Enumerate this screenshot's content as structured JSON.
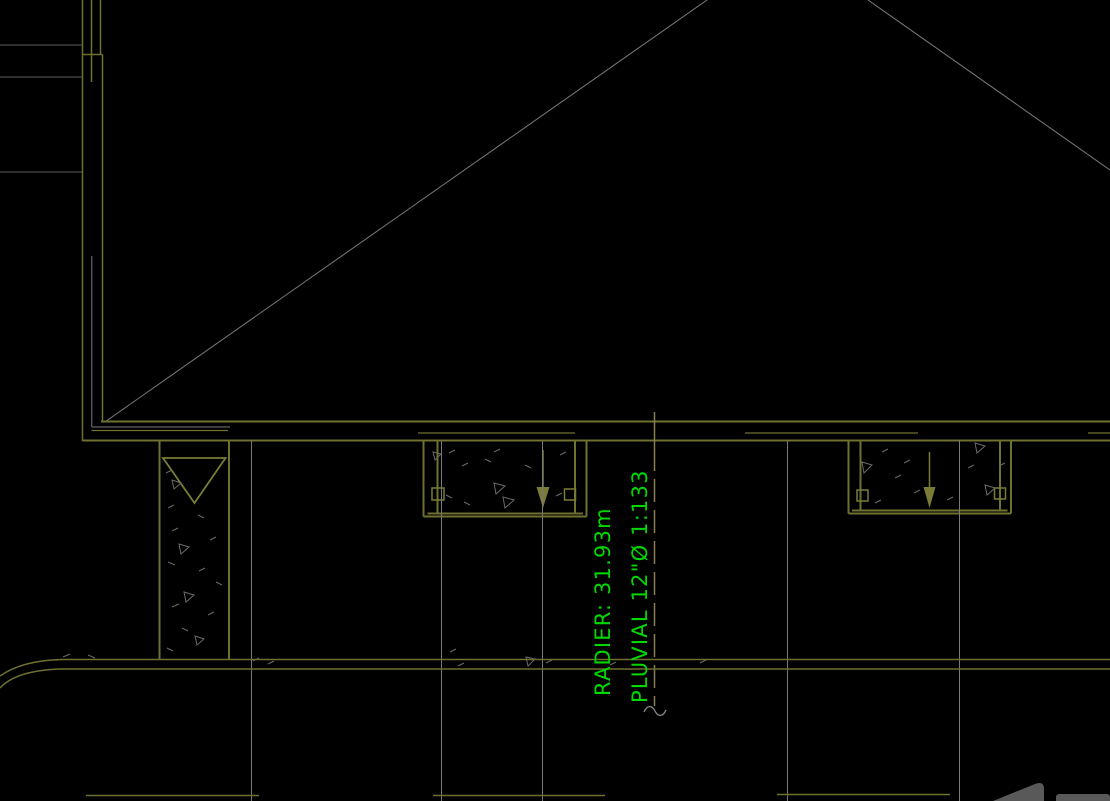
{
  "viewport": {
    "kind": "cad-drawing-viewport",
    "background": "#000000"
  },
  "annotation": {
    "rotation_deg": -90,
    "color": "#00d900",
    "lines": [
      {
        "id": "radier",
        "text": "RADIER: 31.93m"
      },
      {
        "id": "pluvial",
        "text": "PLUVIAL 12\"Ø 1:133"
      }
    ]
  },
  "palette": {
    "bg": "#000000",
    "olive": "#6f7130",
    "olive2": "#7a7c35",
    "gray": "#7a7a7a",
    "darkgray": "#2e2e31",
    "tan": "#8b7d55",
    "green": "#00d900",
    "stipple": "#6a6a6a",
    "wm": "#595959"
  }
}
